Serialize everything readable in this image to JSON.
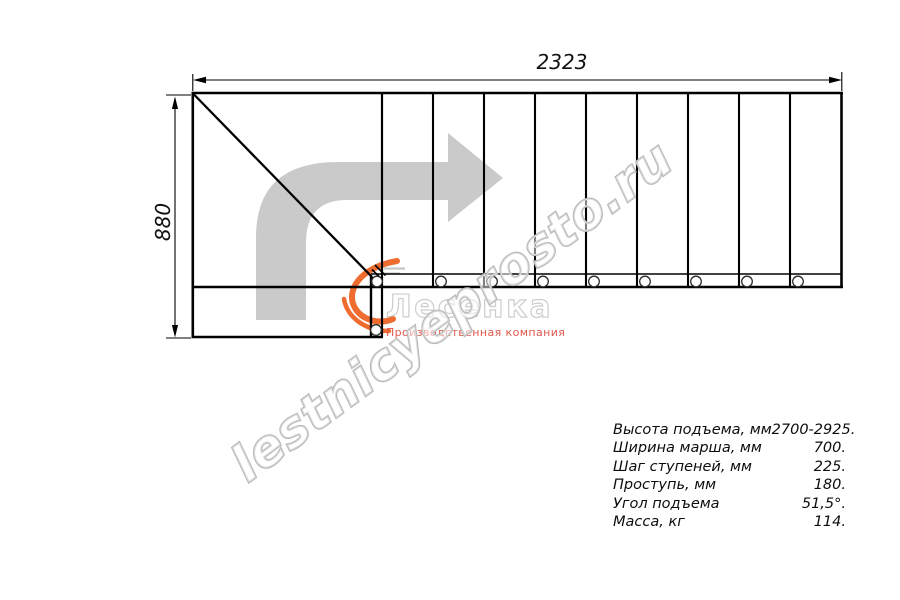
{
  "drawing": {
    "top_dimension_mm": "2323",
    "left_dimension_mm": "880",
    "straight_step_count": 9,
    "line_color": "#000000",
    "arrow_color": "#cacaca"
  },
  "watermark": {
    "text": "lestnicyeprosto.ru"
  },
  "logo": {
    "name": "Лесенка",
    "subtitle": "Производственная компания",
    "accent_color": "#ee6c30",
    "outline_color": "#c9c9c9",
    "subtitle_color": "#e2574c"
  },
  "specs": {
    "rows": [
      {
        "label": "Высота подъема, мм",
        "value": "2700-2925."
      },
      {
        "label": "Ширина марша, мм",
        "value": "700."
      },
      {
        "label": "Шаг ступеней, мм",
        "value": "225."
      },
      {
        "label": "Проступь, мм",
        "value": "180."
      },
      {
        "label": "Угол подъема",
        "value": "51,5°."
      },
      {
        "label": "Масса, кг",
        "value": "114."
      }
    ]
  }
}
